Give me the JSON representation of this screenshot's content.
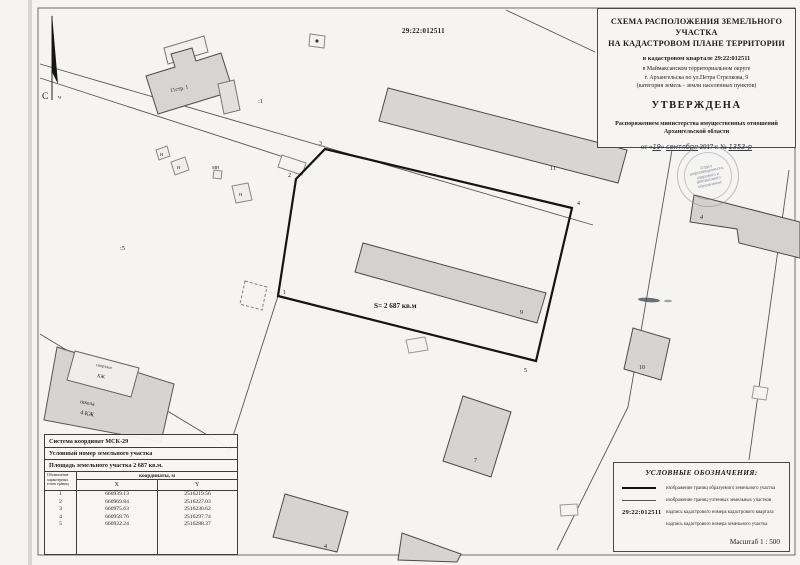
{
  "header": {
    "title1": "СХЕМА РАСПОЛОЖЕНИЯ ЗЕМЕЛЬНОГО УЧАСТКА",
    "title2": "НА КАДАСТРОВОМ ПЛАНЕ ТЕРРИТОРИИ",
    "quarter_line": "в кадастровом квартале 29:22:012511",
    "okrug_line": "в Маймаксанском территориальном округе",
    "address_line": "г. Архангельска по ул.Петра Стрелкова, 9",
    "category_line": "(категория земель - земли населенных пунктов)",
    "approved": "УТВЕРЖДЕНА",
    "order_line1": "Распоряжением министерства имущественных отношений",
    "order_line2": "Архангельской области",
    "date_prefix": "от «",
    "date_day": "19",
    "date_mid": "»",
    "date_month": "сентября",
    "date_year": "2017 г. №",
    "date_number": "1353-р"
  },
  "stamp": {
    "line1": "Отдел",
    "line2": "информационного,",
    "line3": "кадрового и",
    "line4": "финансового",
    "line5": "обеспечения"
  },
  "map": {
    "quarter_number": "29:22:012511",
    "north_label": "С",
    "north_mark": "ч",
    "area_label": "S= 2 687 кв.м",
    "parcel_labels": {
      "p1": ":1",
      "p5": ":5"
    },
    "building_labels": {
      "b11s1": "11стр. 1",
      "b11": "11",
      "b9": "9",
      "b7": "7",
      "b4": "4",
      "b4r": "4",
      "b10": "10",
      "shed1": "Н",
      "shed2": "Н",
      "shed3": "Н",
      "shed_mn": "МН",
      "school1": "школа",
      "school2": "4 КЖ",
      "gym1": "спортзал",
      "gym2": "КЖ"
    },
    "points": {
      "p1": "1",
      "p2": "2",
      "p3": "3",
      "p4": "4",
      "p5": "5"
    }
  },
  "table": {
    "coord_system": "Система координат МСК-29",
    "conditional_number": "Условный номер земельного участка",
    "area": "Площадь земельного участка 2 687 кв.м.",
    "col_designation": "Обозначение характерных точек границ",
    "col_coordinates": "координаты, м",
    "col_x": "X",
    "col_y": "Y",
    "rows": [
      {
        "n": "1",
        "x": "660939.13",
        "y": "2516219.56"
      },
      {
        "n": "2",
        "x": "660969.84",
        "y": "2516227.03"
      },
      {
        "n": "3",
        "x": "660975.63",
        "y": "2516230.62"
      },
      {
        "n": "4",
        "x": "660958.76",
        "y": "2516297.74"
      },
      {
        "n": "5",
        "x": "660922.24",
        "y": "2516288.37"
      }
    ]
  },
  "legend": {
    "title": "УСЛОВНЫЕ ОБОЗНАЧЕНИЯ:",
    "item1": "изображение границ образуемого земельного участка",
    "item2": "изображение границ учтенных земельных участков",
    "item3_symbol": "29:22:012511",
    "item3": "надпись кадастрового номера кадастрового квартала",
    "item4": "надпись кадастрового номера земельного участка",
    "scale": "Масштаб 1 : 500"
  }
}
